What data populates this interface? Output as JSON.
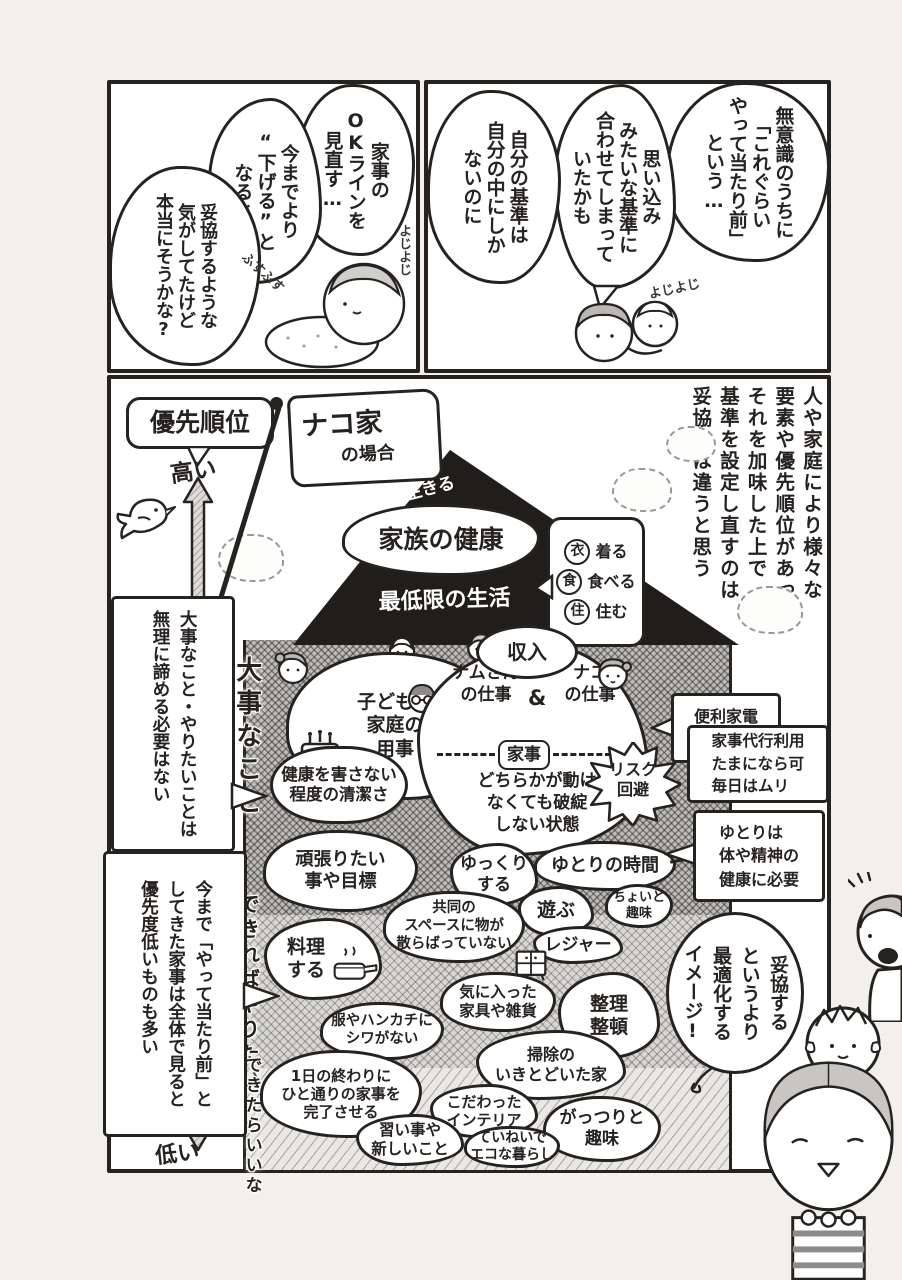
{
  "colors": {
    "ink": "#262220",
    "paper": "#ffffff",
    "page_bg": "#f1f0ed",
    "roof_black": "#211d1a",
    "hair_gray": "#b9b8b5"
  },
  "tl": {
    "b1": "家事の\nOKラインを\n見直す…",
    "b2": "今までより\n“下げる”と\nなると",
    "b3": "妥協するような\n気がしてたけど\n本当にそうかな?",
    "sfx1": "よじよじ",
    "sfx2": "ふすふす"
  },
  "tr": {
    "b1": "無意識のうちに\n「これぐらい\nやって当たり前」\nという…",
    "b2": "思い込み\nみたいな基準に\n合わせてしまって\nいたかも",
    "b3": "自分の基準は\n自分の中にしか\nないのに",
    "sfx1": "よじよじ"
  },
  "m": {
    "narration": "人や家庭により様々な\n要素や優先順位があって\nそれを加味した上で\n基準を設定し直すのは\n妥協とは違うと思う",
    "flag_line1": "ナコ家",
    "flag_line2": "の場合",
    "axis_title": "優先順位",
    "axis_high": "高い",
    "axis_low": "低い",
    "peak": "生きる",
    "health": "家族の健康",
    "minimum": "最低限の生活",
    "ishokuju": [
      {
        "mark": "衣",
        "label": "着る"
      },
      {
        "mark": "食",
        "label": "食べる"
      },
      {
        "mark": "住",
        "label": "住む"
      }
    ],
    "income": "収入",
    "tier1": "大事なこと",
    "tier2": "できればやりたい",
    "tier3": "できたらいいな",
    "kids": "子どもや\n家庭の\n用事",
    "work1": "ナムさん\nの仕事",
    "amp": "&",
    "work2": "ナコ\nの仕事",
    "kaji": "家事",
    "breakdown": "どちらかが動け\nなくても破綻\nしない状態",
    "risk": "リスク\n回避",
    "clean": "健康を害さない\n程度の清潔さ",
    "goals": "頑張りたい\n事や目標",
    "relax": "ゆっくり\nする",
    "metime": "ゆとりの時間",
    "play": "遊ぶ",
    "hobby_s": "ちょいと\n趣味",
    "leisure": "レジャー",
    "shared": "共同の\nスペースに物が\n散らばっていない",
    "cook": "料理\nする",
    "furniture": "気に入った\n家具や雑貨",
    "tidy": "整理\n整頓",
    "wrinkle": "服やハンカチに\nシワがない",
    "sweep": "掃除の\nいきとどいた家",
    "finish": "1日の終わりに\nひと通りの家事を\n完了させる",
    "interior": "こだわった\nインテリア",
    "hobby_l": "がっつりと\n趣味",
    "lessons": "習い事や\n新しいこと",
    "eco": "ていねいで\nエコな暮らし",
    "note_appliance": "便利家電\n購入可",
    "note_daiko": "家事代行利用\nたまになら可\n毎日はムリ",
    "note_yutori": "ゆとりは\n体や精神の\n健康に必要",
    "note_left1": "大事なこと・やりたいことは\n無理に諦める必要はない",
    "note_left2": "今まで「やって当たり前」と\nしてきた家事は全体で見ると\n優先度低いものも多い",
    "speech": "妥協する\nというより\n最適化する\nイメージ!"
  }
}
